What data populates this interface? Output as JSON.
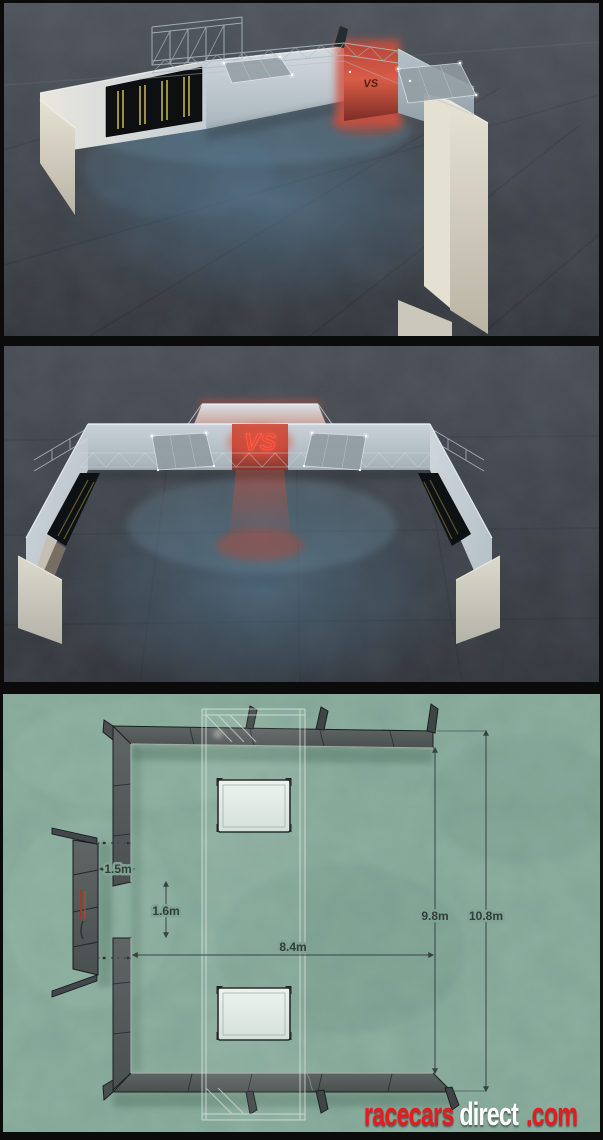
{
  "image": {
    "type": "composite listing image: two night-time 3D renders of a race-team pit structure above a top-down floor plan",
    "frame_color": "#0b0b0c"
  },
  "panels": {
    "render_top": {
      "title": "3d render rear elevated view",
      "logo_text": "VS",
      "ground_color": "#3e434a",
      "wall_color": "#ccd4d9",
      "glow_red": "#d95c46",
      "glow_blue": "#4a6c84"
    },
    "render_front": {
      "title": "3d render front view",
      "logo_text": "VS",
      "ground_color": "#3a3f46",
      "wall_color": "#c6cfd5"
    },
    "floorplan": {
      "title": "top down floor plan",
      "background_color": "#7fa494",
      "wall_color": "#575d5c",
      "dimensions": [
        {
          "id": "wing-gap-width",
          "label": "1.5m"
        },
        {
          "id": "side-door-opening",
          "label": "1.6m"
        },
        {
          "id": "inner-width",
          "label": "8.4m"
        },
        {
          "id": "inner-depth",
          "label": "9.8m"
        },
        {
          "id": "outer-depth",
          "label": "10.8m"
        }
      ]
    }
  },
  "brand": {
    "part_racecars": "racecars",
    "part_direct": "direct",
    "part_com": ".com",
    "color_red": "#e51f1f",
    "color_white": "#ffffff"
  }
}
